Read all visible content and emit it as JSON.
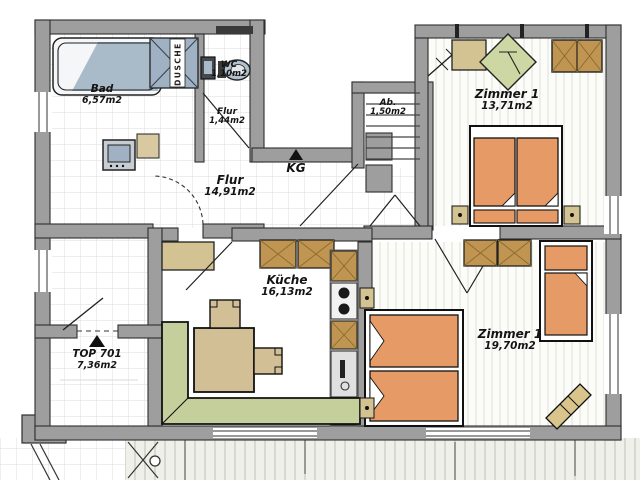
{
  "title": "Grundriss TOP 701",
  "rooms": [
    {
      "name": "Bad",
      "area": "6,57m2"
    },
    {
      "name": "WC",
      "area": "1,10m2"
    },
    {
      "name": "Flur",
      "area": "1,44m2"
    },
    {
      "name": "Ab.",
      "area": "1,50m2"
    },
    {
      "name": "Zimmer 1",
      "area": "13,71m2"
    },
    {
      "name": "Flur",
      "area": "14,91m2"
    },
    {
      "name": "Küche",
      "area": "16,13m2"
    },
    {
      "name": "Zimmer 1",
      "area": "19,70m2"
    },
    {
      "name": "TOP 701",
      "area": "7,36m2"
    }
  ],
  "annotations": {
    "basement_label": "KG",
    "shower_label": "DUSCHE"
  },
  "colors": {
    "wall": "#9e9e9e",
    "outline": "#2e2e2e",
    "bed_orange": "#e69a66",
    "wardrobe_brown": "#c09552",
    "cabinet_tan": "#d3c393",
    "sofa_green": "#c5cf9c",
    "water_blue": "#a9bac9",
    "tile_line": "#e2e2e2"
  }
}
